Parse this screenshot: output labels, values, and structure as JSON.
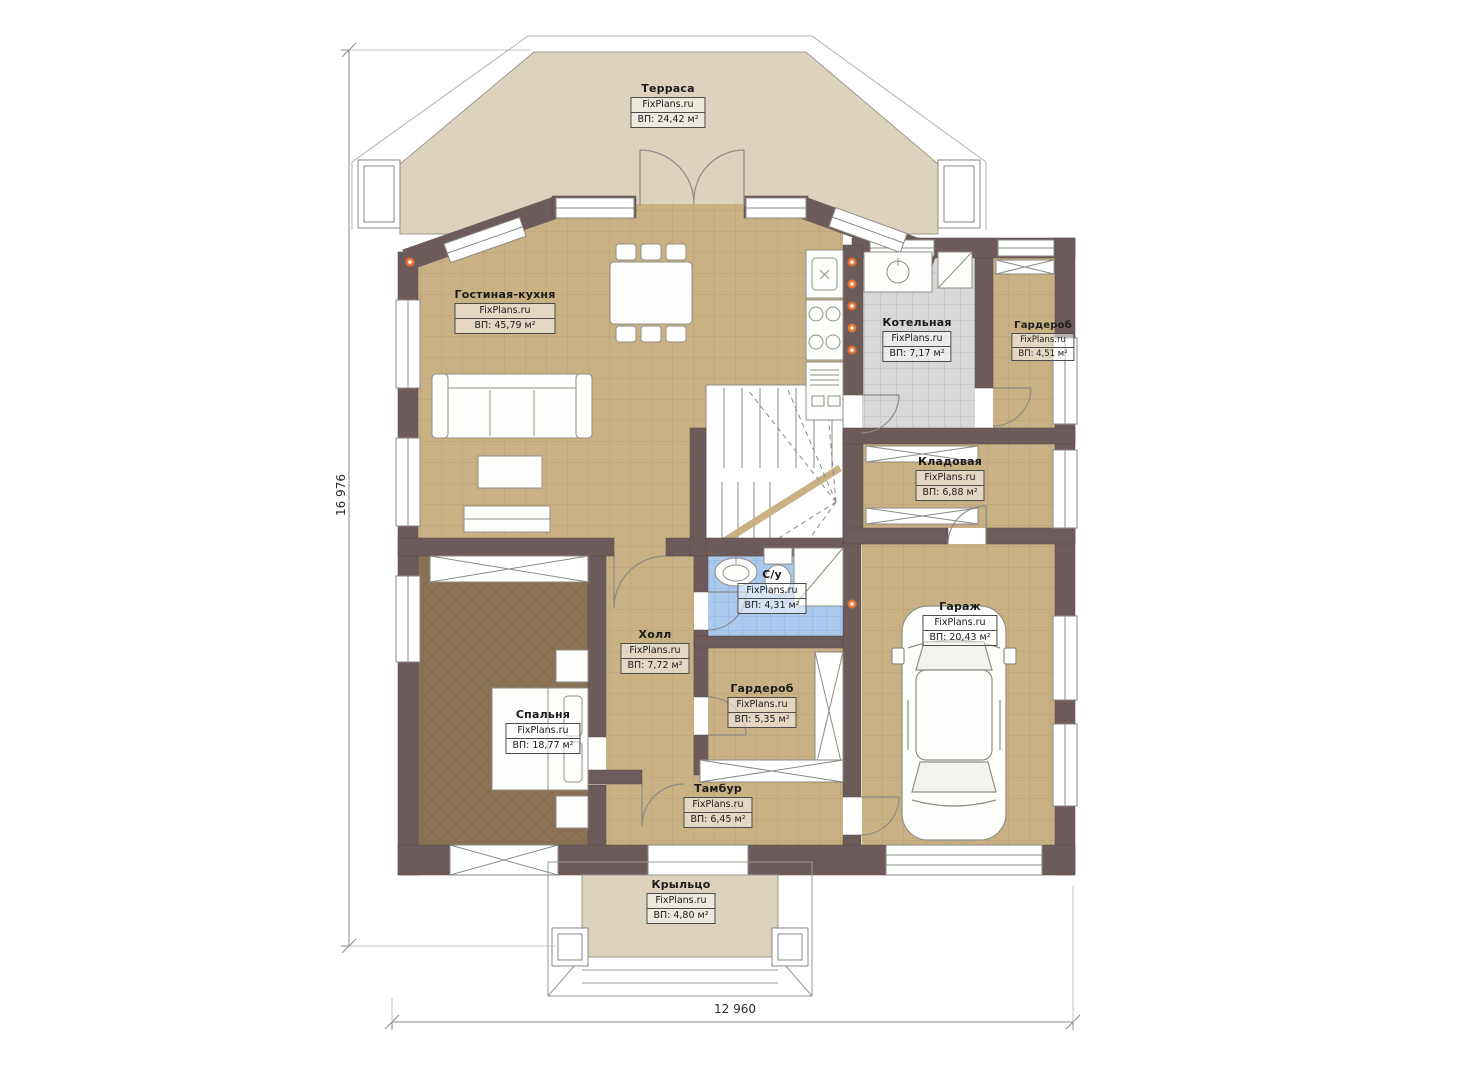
{
  "plan_title": "Floor plan (first floor)",
  "brand": "FixPlans.ru",
  "dimensions": {
    "width_label": "12 960",
    "height_label": "16 976"
  },
  "rooms": [
    {
      "name": "Терраса",
      "brand": "FixPlans.ru",
      "area": "ВП: 24,42 м²"
    },
    {
      "name": "Гостиная-кухня",
      "brand": "FixPlans.ru",
      "area": "ВП: 45,79 м²"
    },
    {
      "name": "Котельная",
      "brand": "FixPlans.ru",
      "area": "ВП: 7,17 м²"
    },
    {
      "name": "Гардероб",
      "brand": "FixPlans.ru",
      "area": "ВП: 4,51 м²"
    },
    {
      "name": "Кладовая",
      "brand": "FixPlans.ru",
      "area": "ВП: 6,88 м²"
    },
    {
      "name": "С/у",
      "brand": "FixPlans.ru",
      "area": "ВП: 4,31 м²"
    },
    {
      "name": "Холл",
      "brand": "FixPlans.ru",
      "area": "ВП: 7,72 м²"
    },
    {
      "name": "Гардероб",
      "brand": "FixPlans.ru",
      "area": "ВП: 5,35 м²"
    },
    {
      "name": "Гараж",
      "brand": "FixPlans.ru",
      "area": "ВП: 20,43 м²"
    },
    {
      "name": "Спальня",
      "brand": "FixPlans.ru",
      "area": "ВП: 18,77 м²"
    },
    {
      "name": "Тамбур",
      "brand": "FixPlans.ru",
      "area": "ВП: 6,45 м²"
    },
    {
      "name": "Крыльцо",
      "brand": "FixPlans.ru",
      "area": "ВП: 4,80 м²"
    }
  ],
  "colors": {
    "wall": "#6d5b5b",
    "floor_tan": "#c9b184",
    "terrace_beige": "#ddd2bc",
    "boiler_gray": "#d8d8d8",
    "bath_blue": "#aac9ed",
    "carpet_brown": "#8b7254",
    "accent_orange": "#e8742f"
  }
}
